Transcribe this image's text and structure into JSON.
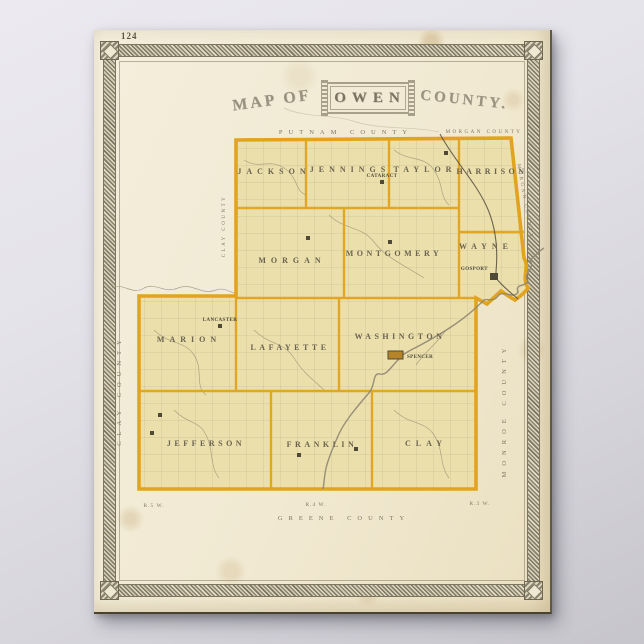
{
  "page_number": "124",
  "title": {
    "prefix": "MAP OF",
    "name": "OWEN",
    "suffix": "COUNTY."
  },
  "map": {
    "townships": [
      {
        "name": "JACKSON"
      },
      {
        "name": "JENNINGS"
      },
      {
        "name": "TAYLOR"
      },
      {
        "name": "HARRISON"
      },
      {
        "name": "MORGAN"
      },
      {
        "name": "MONTGOMERY"
      },
      {
        "name": "WAYNE"
      },
      {
        "name": "MARION"
      },
      {
        "name": "LAFAYETTE"
      },
      {
        "name": "WASHINGTON"
      },
      {
        "name": "JEFFERSON"
      },
      {
        "name": "FRANKLIN"
      },
      {
        "name": "CLAY"
      }
    ],
    "adjacent_counties": {
      "north": "PUTNAM COUNTY",
      "northeast_corner": "MORGAN COUNTY",
      "northeast_edge": "MORGAN COUNTY",
      "east": "MONROE COUNTY",
      "west": "CLAY COUNTY",
      "west_inner": "CLAY COUNTY",
      "south": "GREENE COUNTY"
    },
    "towns": [
      {
        "name": "CATARACT"
      },
      {
        "name": "LANCASTER"
      },
      {
        "name": "SPENCER"
      },
      {
        "name": "GOSPORT"
      }
    ],
    "range_labels": [
      "R.5 W.",
      "R.4 W.",
      "R.3 W."
    ]
  },
  "colors": {
    "county_boundary": "#e2a41f",
    "township_fill": "#ebdfab",
    "paper": "#f1e9d2",
    "background": "#d9d8de",
    "border_band": "#8b8371"
  }
}
